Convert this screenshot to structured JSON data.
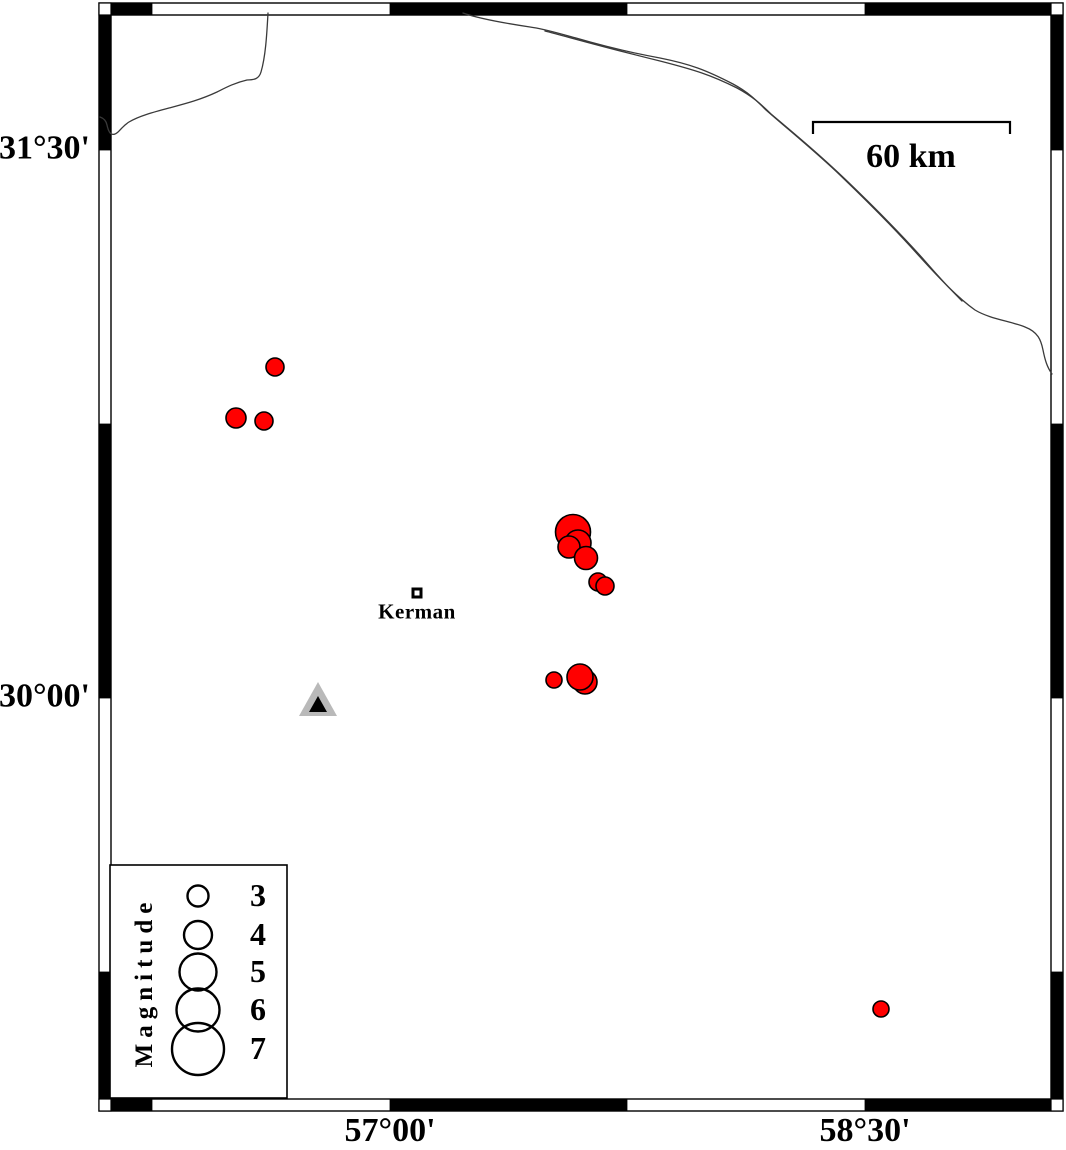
{
  "figure": {
    "description": "Seismicity map of the Kerman region with epicenter symbols scaled by magnitude",
    "colors": {
      "epicenter_fill": "#ff0000",
      "marker_outline": "#000000",
      "station_fill": "#b9b9b9",
      "station_inner": "#000000",
      "river_line": "#3a3a3a",
      "background": "#ffffff"
    }
  },
  "map": {
    "lat_labels": [
      {
        "text": "31°30'",
        "y": 150
      },
      {
        "text": "30°00'",
        "y": 698
      }
    ],
    "lon_labels": [
      {
        "text": "57°00'",
        "x": 390
      },
      {
        "text": "58°30'",
        "x": 865
      }
    ],
    "scale_bar": {
      "label": "60 km"
    },
    "city": {
      "name": "Kerman",
      "x": 417,
      "y": 593
    },
    "station": {
      "x": 318,
      "y": 701
    },
    "earthquakes": [
      {
        "x": 275,
        "y": 367,
        "r": 9
      },
      {
        "x": 236,
        "y": 418,
        "r": 10
      },
      {
        "x": 264,
        "y": 421,
        "r": 9
      },
      {
        "x": 573,
        "y": 532,
        "r": 17.5
      },
      {
        "x": 578,
        "y": 543,
        "r": 13
      },
      {
        "x": 569,
        "y": 547,
        "r": 11
      },
      {
        "x": 586,
        "y": 558,
        "r": 11.5
      },
      {
        "x": 598,
        "y": 582,
        "r": 9
      },
      {
        "x": 605,
        "y": 586,
        "r": 9
      },
      {
        "x": 554,
        "y": 680,
        "r": 8
      },
      {
        "x": 585,
        "y": 682,
        "r": 12
      },
      {
        "x": 580,
        "y": 677,
        "r": 13
      },
      {
        "x": 881,
        "y": 1009,
        "r": 8
      }
    ]
  },
  "legend": {
    "title": "Magnitude",
    "entries": [
      {
        "magnitude": "3",
        "radius_px": 10.5
      },
      {
        "magnitude": "4",
        "radius_px": 14
      },
      {
        "magnitude": "5",
        "radius_px": 18.5
      },
      {
        "magnitude": "6",
        "radius_px": 21.5
      },
      {
        "magnitude": "7",
        "radius_px": 26
      }
    ]
  }
}
